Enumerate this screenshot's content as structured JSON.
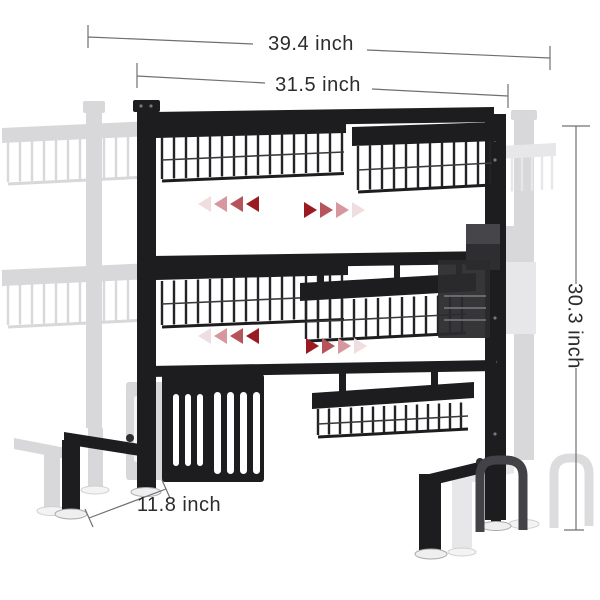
{
  "figure": {
    "subject": "2-tier expandable over-sink dish drying rack",
    "style": "product dimension diagram with ghosted extended position"
  },
  "dimensions": {
    "overall_width": "39.4 inch",
    "shelf_width": "31.5 inch",
    "height": "30.3 inch",
    "depth": "11.8 inch"
  },
  "icons": {
    "expand_arrows": "fading-triangle-arrows"
  },
  "colors": {
    "rack": "#1d1d1f",
    "rack_soft": "#3f3f42",
    "ghost": "#d8d8da",
    "ghost_soft": "#e7e7e9",
    "dimension_line": "#707070",
    "label_text": "#2c2c2c",
    "slot_white": "#ffffff",
    "foot": "#efefef",
    "arrow_gradient": [
      "#9b1a22",
      "#b5545b",
      "#d6989e",
      "#f0dde0"
    ]
  }
}
